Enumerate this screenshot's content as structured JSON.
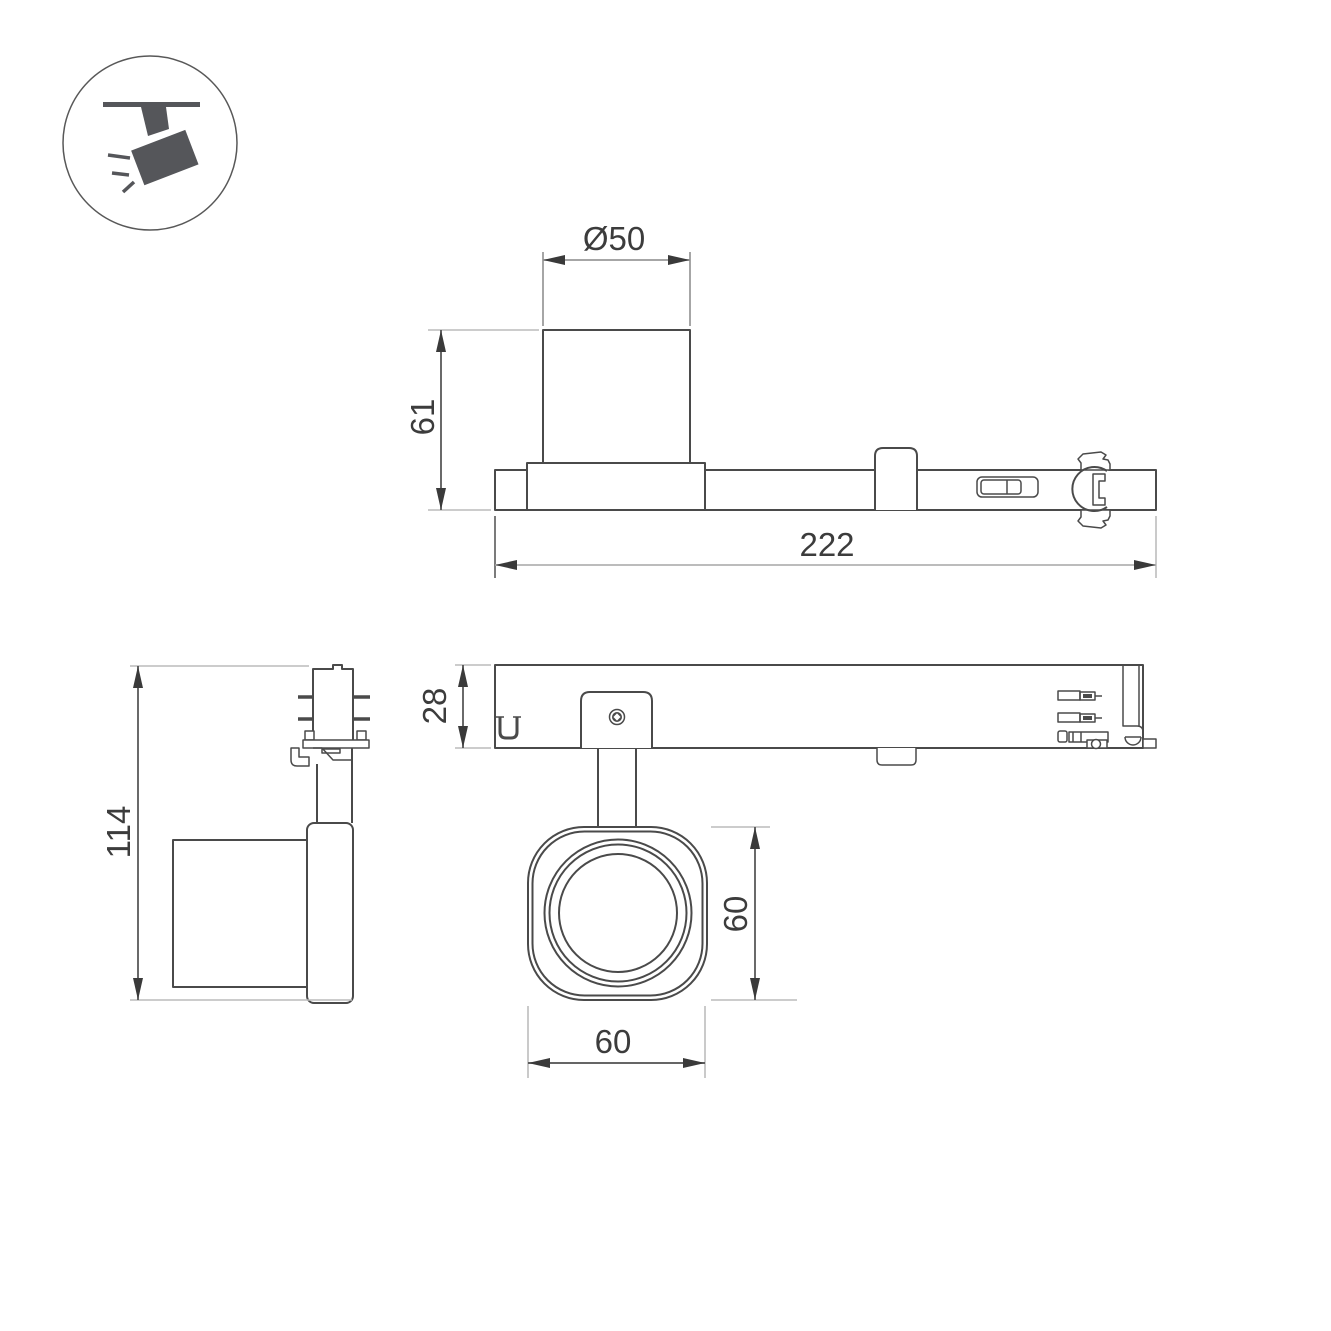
{
  "drawing": {
    "type": "technical-dimension-drawing",
    "product_icon": "ceiling-track-spotlight",
    "views": {
      "top_side_view": {
        "labels": {
          "diameter": "Ø50",
          "height": "61",
          "length": "222"
        }
      },
      "left_side_view": {
        "labels": {
          "height": "114"
        }
      },
      "bottom_view": {
        "labels": {
          "depth": "28",
          "head_height": "60",
          "head_width": "60"
        }
      }
    },
    "colors": {
      "object_line": "#4a4a4a",
      "dimension_line": "#9a9a9a",
      "extension_line": "#bcbcbc",
      "text": "#3c3c3c",
      "icon_fill": "#55565a",
      "background": "#ffffff"
    }
  }
}
